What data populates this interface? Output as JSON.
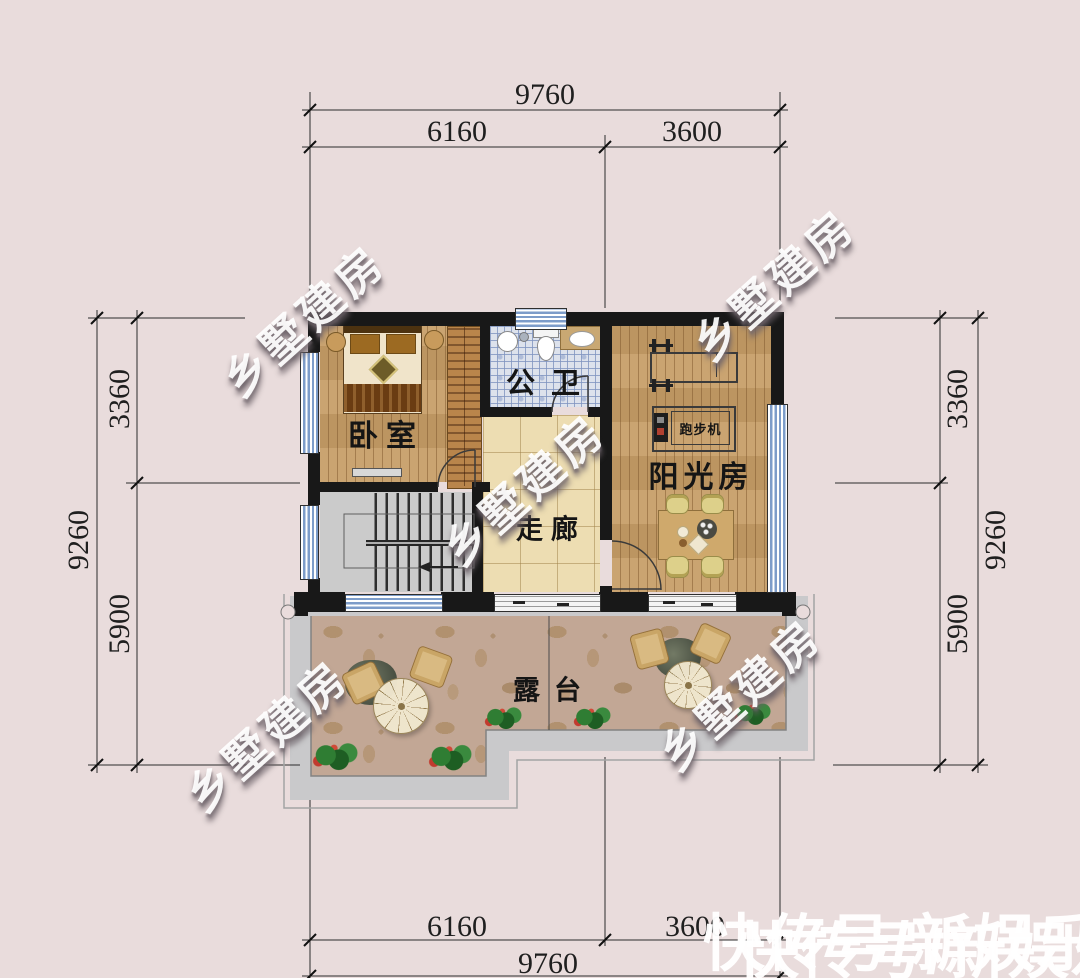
{
  "page": {
    "background_color": "#e9dcdc"
  },
  "plan": {
    "rooms": [
      {
        "key": "bedroom",
        "label": "卧室"
      },
      {
        "key": "bathroom",
        "label": "公卫"
      },
      {
        "key": "corridor",
        "label": "走廊"
      },
      {
        "key": "sunroom",
        "label": "阳光房"
      },
      {
        "key": "terrace",
        "label": "露台"
      }
    ],
    "furniture": {
      "treadmill_label": "跑步机"
    }
  },
  "dimensions": {
    "top": {
      "overall": "9760",
      "left": "6160",
      "right": "3600"
    },
    "bottom": {
      "overall": "9760",
      "left": "6160",
      "right": "3600"
    },
    "left": {
      "overall": "9260",
      "upper": "3360",
      "lower": "5900"
    },
    "right": {
      "overall": "9260",
      "upper": "3360",
      "lower": "5900"
    }
  },
  "watermarks": {
    "diagonal_text": "乡墅建房",
    "footer_text": "快传号/新娱乐"
  },
  "colors": {
    "wall": "#181818",
    "wood_floor": "#c69d66",
    "bath_tile": "#dde2ec",
    "corridor_tile": "#edddb2",
    "stairs": "#cbcbcb",
    "terrace": "#c2a795",
    "window_glass": "#7d9cc9",
    "dimension_line": "#2c2c2c",
    "watermark_white": "#ffffff"
  }
}
